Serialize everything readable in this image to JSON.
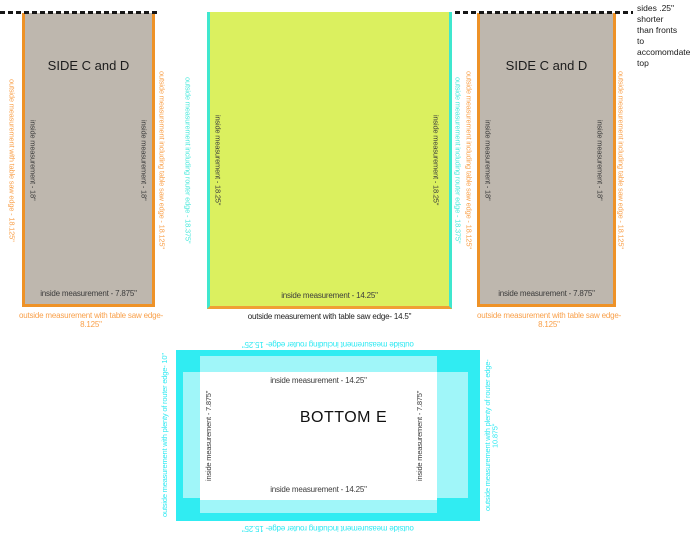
{
  "note": "sides .25\" shorter\nthan fronts\nto accomomdate\ntop",
  "side_left": {
    "title": "SIDE C and D",
    "outside_left": "outside measurement with table saw edge - 18.125\"",
    "inside_left": "inside measurement - 18\"",
    "inside_right": "inside measurement - 18\"",
    "outside_right": "outside measurement including table saw edge - 18.125\"",
    "inside_bottom": "inside measurement - 7.875\"",
    "outside_bottom": "outside measurement with table saw edge- 8.125\""
  },
  "front_center": {
    "outside_left": "outside measurement including router edge - 18.375\"",
    "inside_left": "inside measurement - 18.25\"",
    "inside_right": "inside measurement - 18.25\"",
    "outside_right": "outside measurement including router edge - 18.375\"",
    "inside_bottom": "inside measurement - 14.25\"",
    "outside_bottom": "outside measurement with table saw edge- 14.5\""
  },
  "side_right": {
    "title": "SIDE C and D",
    "outside_left": "outside measurement including table saw edge - 18.125\"",
    "inside_left": "inside measurement - 18\"",
    "inside_right": "inside measurement - 18\"",
    "outside_right": "outside measurement including table saw edge - 18.125\"",
    "inside_bottom": "inside measurement - 7.875\"",
    "outside_bottom": "outside measurement with table saw edge- 8.125\""
  },
  "bottom_e": {
    "title": "BOTTOM E",
    "outside_top": "outside measurement including router edge- 15.25\"",
    "inside_top": "inside measurement - 14.25\"",
    "inside_left": "inside measurement - 7.875\"",
    "inside_right": "inside measurement - 7.875\"",
    "inside_bottom": "inside measurement - 14.25\"",
    "outside_bottom": "outside measurement including router edge- 15.25\"",
    "outside_left": "outside measurement with plenty of router edge- 10\"",
    "outside_right": "outside measurement with plenty of router edge- 10.875\""
  },
  "colors": {
    "orange_edge": "#ee9227",
    "orange_text": "#f9a04a",
    "teal_edge": "#3fe7ce",
    "teal_text": "#49e9dc",
    "bottom_cyan": "#30ecf2",
    "bottom_cyan_light": "#a0f6f9",
    "bottom_cyan_text": "#2fe9f2",
    "side_panel_fill": "#beb7ae",
    "front_panel_fill": "#dbf05f",
    "ink": "#3c3c3c"
  }
}
